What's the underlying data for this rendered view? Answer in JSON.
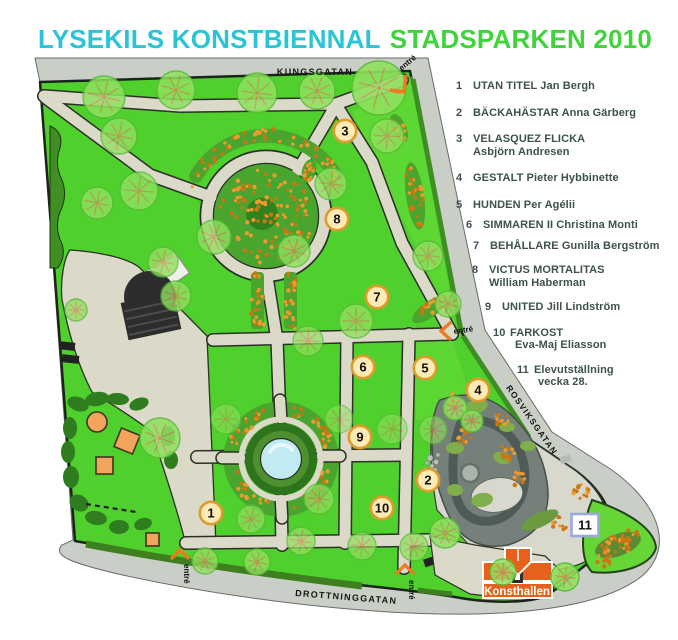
{
  "title": {
    "part1": "LYSEKILS KONSTBIENNAL",
    "part2": "STADSPARKEN 2010"
  },
  "colors": {
    "title_cyan": "#2AC4D6",
    "title_green": "#3DD53A",
    "legend_text": "#3C524A",
    "lawn_green": "#50D02C",
    "path_beige": "#DBD9C8",
    "road_gray": "#C9CEC7",
    "marker_fill": "#FDEBB5",
    "marker_border": "#DF9A2C",
    "marker11_border": "#9BA9DF",
    "entre_orange": "#F07820",
    "konsthallen_orange": "#E8611C",
    "water_blue": "#C2EAF2"
  },
  "map": {
    "streets": [
      {
        "name": "KUNGSGATAN"
      },
      {
        "name": "ROSVIKSGATAN"
      },
      {
        "name": "DROTTNINGGATAN"
      }
    ],
    "entrances_label": "entré",
    "konsthallen_label": "Konsthallen",
    "markers": [
      {
        "num": "1",
        "x": 211,
        "y": 513
      },
      {
        "num": "2",
        "x": 428,
        "y": 480
      },
      {
        "num": "3",
        "x": 345,
        "y": 131
      },
      {
        "num": "4",
        "x": 478,
        "y": 390
      },
      {
        "num": "5",
        "x": 425,
        "y": 368
      },
      {
        "num": "6",
        "x": 363,
        "y": 367
      },
      {
        "num": "7",
        "x": 377,
        "y": 297
      },
      {
        "num": "8",
        "x": 337,
        "y": 219
      },
      {
        "num": "9",
        "x": 360,
        "y": 437
      },
      {
        "num": "10",
        "x": 382,
        "y": 508
      },
      {
        "num": "11",
        "x": 585,
        "y": 525,
        "shape": "square"
      }
    ]
  },
  "legend": {
    "items": [
      {
        "num": "1",
        "lines": [
          "UTAN TITEL Jan Bergh"
        ]
      },
      {
        "num": "2",
        "lines": [
          "BÄCKAHÄSTAR Anna Gärberg"
        ]
      },
      {
        "num": "3",
        "lines": [
          "VELASQUEZ FLICKA",
          "Asbjörn Andresen"
        ]
      },
      {
        "num": "4",
        "lines": [
          "GESTALT Pieter Hybbinette"
        ]
      },
      {
        "num": "5",
        "lines": [
          "HUNDEN Per Agélii"
        ]
      },
      {
        "num": "6",
        "lines": [
          "SIMMAREN II Christina Monti"
        ]
      },
      {
        "num": "7",
        "lines": [
          "BEHÅLLARE Gunilla Bergström"
        ]
      },
      {
        "num": "8",
        "lines": [
          "VICTUS MORTALITAS",
          "William Haberman"
        ]
      },
      {
        "num": "9",
        "lines": [
          "UNITED Jill Lindström"
        ]
      },
      {
        "num": "10",
        "lines": [
          "FARKOST",
          "Eva-Maj Eliasson"
        ]
      },
      {
        "num": "11",
        "lines": [
          "Elevutställning",
          "vecka 28."
        ]
      }
    ]
  }
}
